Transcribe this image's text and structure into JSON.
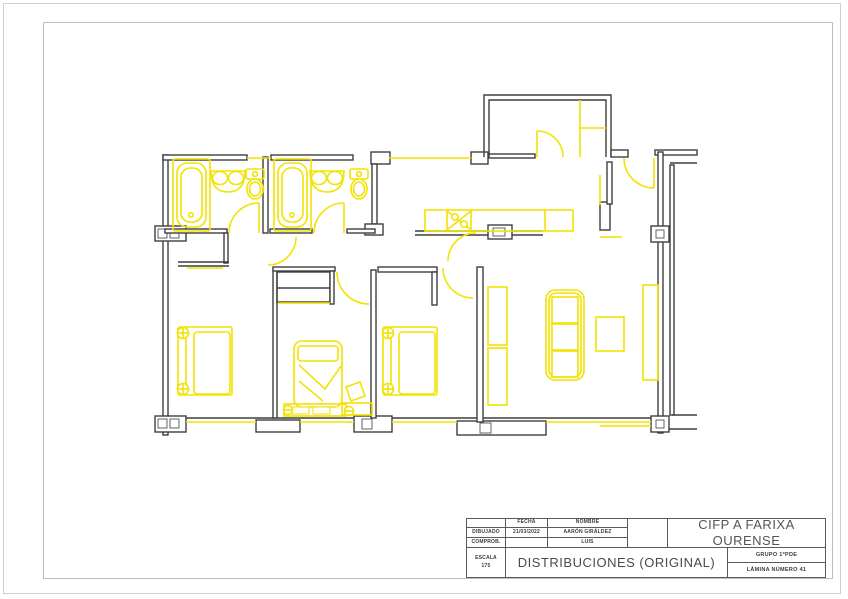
{
  "page": {
    "background": "#ffffff",
    "outer_border_color": "#cfcfcf",
    "inner_border_color": "#bdbdbd"
  },
  "title_block": {
    "fields": {
      "fecha_label": "FECHA",
      "nombre_label": "NOMBRE",
      "dibujado_label": "DIBUJADO",
      "fecha_value": "21/03/2022",
      "dibujado_nombre": "AARÓN GIRÁLDEZ",
      "comprob_label": "COMPROB.",
      "comprob_nombre": "LUIS",
      "escala_label": "ESCALA",
      "escala_value": "175",
      "drawing_title": "DISTRIBUCIONES (ORIGINAL)",
      "school_line1": "CIFP A FARIXA",
      "school_line2": "OURENSE",
      "grupo": "GRUPO 1ºPDE",
      "lamina": "LÁMINA NÚMERO 41"
    }
  },
  "plan": {
    "wall_color": "#3f3f3f",
    "accent_color": "#f2e300",
    "shapes": [
      {
        "t": "r",
        "x": 163,
        "y": 155,
        "w": 5,
        "h": 280,
        "f": "w"
      },
      {
        "t": "r",
        "x": 163,
        "y": 155,
        "w": 84,
        "h": 5,
        "f": "w"
      },
      {
        "t": "r",
        "x": 271,
        "y": 155,
        "w": 82,
        "h": 5,
        "f": "w"
      },
      {
        "t": "r",
        "x": 371,
        "y": 152,
        "w": 19,
        "h": 12,
        "f": "w"
      },
      {
        "t": "r",
        "x": 372,
        "y": 164,
        "w": 5,
        "h": 60,
        "f": "w"
      },
      {
        "t": "r",
        "x": 365,
        "y": 224,
        "w": 18,
        "h": 11,
        "f": "w"
      },
      {
        "t": "r",
        "x": 471,
        "y": 152,
        "w": 17,
        "h": 12,
        "f": "w"
      },
      {
        "t": "p",
        "d": "M484,157 L484,95 L611,95 L611,157"
      },
      {
        "t": "p",
        "d": "M489,157 L489,100 L606,100 L606,157"
      },
      {
        "t": "r",
        "x": 489,
        "y": 154,
        "w": 46,
        "h": 4,
        "f": "w"
      },
      {
        "t": "r",
        "x": 611,
        "y": 150,
        "w": 17,
        "h": 7,
        "f": "w"
      },
      {
        "t": "r",
        "x": 655,
        "y": 150,
        "w": 42,
        "h": 5,
        "f": "w"
      },
      {
        "t": "l",
        "x1": 670,
        "y1": 163,
        "x2": 697,
        "y2": 163
      },
      {
        "t": "r",
        "x": 658,
        "y": 152,
        "w": 5,
        "h": 281,
        "f": "w"
      },
      {
        "t": "r",
        "x": 670,
        "y": 165,
        "w": 4,
        "h": 250,
        "f": "w"
      },
      {
        "t": "l",
        "x1": 672,
        "y1": 415,
        "x2": 697,
        "y2": 415
      },
      {
        "t": "l",
        "x1": 657,
        "y1": 429,
        "x2": 697,
        "y2": 429
      },
      {
        "t": "l",
        "x1": 164,
        "y1": 418,
        "x2": 662,
        "y2": 418
      },
      {
        "t": "r",
        "x": 651,
        "y": 226,
        "w": 18,
        "h": 16,
        "f": "w"
      },
      {
        "t": "r",
        "x": 656,
        "y": 230,
        "w": 8,
        "h": 8,
        "f": "w",
        "sw": 0.8
      },
      {
        "t": "r",
        "x": 651,
        "y": 416,
        "w": 18,
        "h": 16,
        "f": "w"
      },
      {
        "t": "r",
        "x": 656,
        "y": 420,
        "w": 8,
        "h": 8,
        "f": "w",
        "sw": 0.8
      },
      {
        "t": "r",
        "x": 155,
        "y": 416,
        "w": 31,
        "h": 16,
        "f": "w"
      },
      {
        "t": "r",
        "x": 158,
        "y": 419,
        "w": 9,
        "h": 9,
        "f": "w",
        "sw": 0.8
      },
      {
        "t": "r",
        "x": 170,
        "y": 419,
        "w": 9,
        "h": 9,
        "f": "w",
        "sw": 0.8
      },
      {
        "t": "r",
        "x": 256,
        "y": 420,
        "w": 44,
        "h": 12,
        "f": "w"
      },
      {
        "t": "r",
        "x": 354,
        "y": 416,
        "w": 38,
        "h": 16,
        "f": "w"
      },
      {
        "t": "r",
        "x": 362,
        "y": 419,
        "w": 10,
        "h": 10,
        "f": "w",
        "sw": 0.8
      },
      {
        "t": "r",
        "x": 457,
        "y": 421,
        "w": 89,
        "h": 14,
        "f": "w"
      },
      {
        "t": "r",
        "x": 480,
        "y": 423,
        "w": 11,
        "h": 10,
        "f": "w",
        "sw": 0.8
      },
      {
        "t": "r",
        "x": 155,
        "y": 226,
        "w": 31,
        "h": 15,
        "f": "w"
      },
      {
        "t": "r",
        "x": 158,
        "y": 229,
        "w": 9,
        "h": 9,
        "f": "w",
        "sw": 0.8
      },
      {
        "t": "r",
        "x": 170,
        "y": 229,
        "w": 9,
        "h": 9,
        "f": "w",
        "sw": 0.8
      },
      {
        "t": "r",
        "x": 263,
        "y": 157,
        "w": 5,
        "h": 76,
        "f": "w"
      },
      {
        "t": "r",
        "x": 165,
        "y": 229,
        "w": 62,
        "h": 4,
        "f": "w"
      },
      {
        "t": "r",
        "x": 224,
        "y": 233,
        "w": 4,
        "h": 30,
        "f": "w"
      },
      {
        "t": "l",
        "x1": 178,
        "y1": 262,
        "x2": 229,
        "y2": 262
      },
      {
        "t": "l",
        "x1": 178,
        "y1": 266,
        "x2": 229,
        "y2": 266
      },
      {
        "t": "r",
        "x": 270,
        "y": 229,
        "w": 42,
        "h": 4,
        "f": "w"
      },
      {
        "t": "r",
        "x": 347,
        "y": 229,
        "w": 28,
        "h": 4,
        "f": "w"
      },
      {
        "t": "r",
        "x": 371,
        "y": 270,
        "w": 5,
        "h": 148,
        "f": "w"
      },
      {
        "t": "r",
        "x": 273,
        "y": 270,
        "w": 4,
        "h": 148,
        "f": "w"
      },
      {
        "t": "r",
        "x": 273,
        "y": 267,
        "w": 62,
        "h": 4,
        "f": "w"
      },
      {
        "t": "r",
        "x": 277,
        "y": 272,
        "w": 53,
        "h": 30
      },
      {
        "t": "l",
        "x1": 277,
        "y1": 288,
        "x2": 330,
        "y2": 288
      },
      {
        "t": "r",
        "x": 330,
        "y": 271,
        "w": 4,
        "h": 33,
        "f": "w"
      },
      {
        "t": "r",
        "x": 378,
        "y": 267,
        "w": 59,
        "h": 5,
        "f": "w"
      },
      {
        "t": "r",
        "x": 432,
        "y": 272,
        "w": 5,
        "h": 33,
        "f": "w"
      },
      {
        "t": "r",
        "x": 477,
        "y": 267,
        "w": 6,
        "h": 155,
        "f": "w"
      },
      {
        "t": "l",
        "x1": 415,
        "y1": 231,
        "x2": 543,
        "y2": 231
      },
      {
        "t": "l",
        "x1": 415,
        "y1": 235,
        "x2": 543,
        "y2": 235
      },
      {
        "t": "r",
        "x": 488,
        "y": 225,
        "w": 24,
        "h": 14,
        "f": "w"
      },
      {
        "t": "r",
        "x": 493,
        "y": 228,
        "w": 12,
        "h": 8,
        "f": "w",
        "sw": 0.8
      },
      {
        "t": "r",
        "x": 600,
        "y": 202,
        "w": 10,
        "h": 28
      },
      {
        "t": "r",
        "x": 607,
        "y": 162,
        "w": 5,
        "h": 42,
        "f": "w"
      },
      {
        "t": "l",
        "l": "y",
        "x1": 247,
        "y1": 158,
        "x2": 271,
        "y2": 158
      },
      {
        "t": "l",
        "l": "y",
        "x1": 389,
        "y1": 158,
        "x2": 471,
        "y2": 158
      },
      {
        "t": "l",
        "l": "y",
        "x1": 186,
        "y1": 422,
        "x2": 256,
        "y2": 422
      },
      {
        "t": "l",
        "l": "y",
        "x1": 300,
        "y1": 422,
        "x2": 354,
        "y2": 422
      },
      {
        "t": "l",
        "l": "y",
        "x1": 392,
        "y1": 422,
        "x2": 457,
        "y2": 422
      },
      {
        "t": "l",
        "l": "y",
        "x1": 546,
        "y1": 422,
        "x2": 651,
        "y2": 422
      },
      {
        "t": "l",
        "l": "y",
        "x1": 600,
        "y1": 426,
        "x2": 651,
        "y2": 426
      },
      {
        "t": "l",
        "l": "y",
        "x1": 187,
        "y1": 268,
        "x2": 223,
        "y2": 268
      },
      {
        "t": "l",
        "l": "y",
        "x1": 278,
        "y1": 303,
        "x2": 330,
        "y2": 303
      },
      {
        "t": "l",
        "l": "y",
        "x1": 600,
        "y1": 237,
        "x2": 622,
        "y2": 237
      },
      {
        "t": "l",
        "l": "y",
        "x1": 600,
        "y1": 175,
        "x2": 600,
        "y2": 205
      },
      {
        "t": "l",
        "l": "y",
        "x1": 259,
        "y1": 203,
        "x2": 259,
        "y2": 233
      },
      {
        "t": "p",
        "l": "y",
        "d": "M259,203 A30,30 0 0 0 229,233"
      },
      {
        "t": "l",
        "l": "y",
        "x1": 344,
        "y1": 203,
        "x2": 344,
        "y2": 233
      },
      {
        "t": "p",
        "l": "y",
        "d": "M344,203 A30,30 0 0 0 314,233"
      },
      {
        "t": "p",
        "l": "y",
        "d": "M296,237 A28,28 0 0 1 268,265"
      },
      {
        "t": "p",
        "l": "y",
        "d": "M337,272 A32,32 0 0 0 369,304"
      },
      {
        "t": "p",
        "l": "y",
        "d": "M443,268 A30,30 0 0 0 473,298"
      },
      {
        "t": "l",
        "l": "y",
        "x1": 537,
        "y1": 131,
        "x2": 537,
        "y2": 157
      },
      {
        "t": "p",
        "l": "y",
        "d": "M537,131 A26,26 0 0 1 563,157"
      },
      {
        "t": "l",
        "l": "y",
        "x1": 654,
        "y1": 158,
        "x2": 654,
        "y2": 188
      },
      {
        "t": "p",
        "l": "y",
        "d": "M624,158 A30,30 0 0 0 654,188"
      },
      {
        "t": "p",
        "l": "y",
        "d": "M448,261 A28,28 0 0 1 476,233"
      },
      {
        "t": "l",
        "l": "y",
        "x1": 580,
        "y1": 100,
        "x2": 580,
        "y2": 157
      },
      {
        "t": "l",
        "l": "y",
        "x1": 580,
        "y1": 128,
        "x2": 606,
        "y2": 128
      },
      {
        "t": "r",
        "l": "y",
        "x": 173,
        "y": 159,
        "w": 37,
        "h": 72,
        "rx": 2
      },
      {
        "t": "r",
        "l": "y",
        "x": 177,
        "y": 163,
        "w": 29,
        "h": 64,
        "rx": 10
      },
      {
        "t": "r",
        "l": "y",
        "x": 181,
        "y": 168,
        "w": 21,
        "h": 54,
        "rx": 9
      },
      {
        "t": "c",
        "l": "y",
        "cx": 191,
        "cy": 215,
        "r": 2.2
      },
      {
        "t": "r",
        "l": "y",
        "x": 274,
        "y": 159,
        "w": 37,
        "h": 72,
        "rx": 2
      },
      {
        "t": "r",
        "l": "y",
        "x": 278,
        "y": 163,
        "w": 29,
        "h": 64,
        "rx": 10
      },
      {
        "t": "r",
        "l": "y",
        "x": 282,
        "y": 168,
        "w": 21,
        "h": 54,
        "rx": 9
      },
      {
        "t": "c",
        "l": "y",
        "cx": 292,
        "cy": 215,
        "r": 2.2
      },
      {
        "t": "p",
        "l": "y",
        "d": "M211,171 Q211,192 228,192 Q245,192 245,171 Z"
      },
      {
        "t": "e",
        "l": "y",
        "cx": 220,
        "cy": 178,
        "rx": 7.5,
        "ry": 6.5
      },
      {
        "t": "e",
        "l": "y",
        "cx": 236,
        "cy": 178,
        "rx": 7.5,
        "ry": 6.5
      },
      {
        "t": "p",
        "l": "y",
        "d": "M310,171 Q310,192 327,192 Q344,192 344,171 Z"
      },
      {
        "t": "e",
        "l": "y",
        "cx": 319,
        "cy": 178,
        "rx": 7.5,
        "ry": 6.5
      },
      {
        "t": "e",
        "l": "y",
        "cx": 335,
        "cy": 178,
        "rx": 7.5,
        "ry": 6.5
      },
      {
        "t": "r",
        "l": "y",
        "x": 246,
        "y": 169,
        "w": 18,
        "h": 10,
        "rx": 2
      },
      {
        "t": "c",
        "l": "y",
        "cx": 255,
        "cy": 174,
        "r": 2.4
      },
      {
        "t": "e",
        "l": "y",
        "cx": 255,
        "cy": 189,
        "rx": 8,
        "ry": 10
      },
      {
        "t": "e",
        "l": "y",
        "cx": 255,
        "cy": 189,
        "rx": 5.5,
        "ry": 7
      },
      {
        "t": "r",
        "l": "y",
        "x": 350,
        "y": 169,
        "w": 18,
        "h": 10,
        "rx": 2
      },
      {
        "t": "c",
        "l": "y",
        "cx": 359,
        "cy": 174,
        "r": 2.4
      },
      {
        "t": "e",
        "l": "y",
        "cx": 359,
        "cy": 189,
        "rx": 8,
        "ry": 10
      },
      {
        "t": "e",
        "l": "y",
        "cx": 359,
        "cy": 189,
        "rx": 5.5,
        "ry": 7
      },
      {
        "t": "r",
        "l": "y",
        "x": 425,
        "y": 210,
        "w": 148,
        "h": 21
      },
      {
        "t": "l",
        "l": "y",
        "x1": 447,
        "y1": 210,
        "x2": 447,
        "y2": 231
      },
      {
        "t": "l",
        "l": "y",
        "x1": 471,
        "y1": 210,
        "x2": 471,
        "y2": 231
      },
      {
        "t": "l",
        "l": "y",
        "x1": 545,
        "y1": 210,
        "x2": 545,
        "y2": 231
      },
      {
        "t": "l",
        "l": "y",
        "x1": 447,
        "y1": 211,
        "x2": 471,
        "y2": 230
      },
      {
        "t": "l",
        "l": "y",
        "x1": 471,
        "y1": 211,
        "x2": 447,
        "y2": 230
      },
      {
        "t": "c",
        "l": "y",
        "cx": 455,
        "cy": 217,
        "r": 3.2,
        "f": "w"
      },
      {
        "t": "c",
        "l": "y",
        "cx": 464,
        "cy": 224,
        "r": 3.2,
        "f": "w"
      },
      {
        "t": "r",
        "l": "y",
        "x": 178,
        "y": 327,
        "w": 54,
        "h": 68,
        "rx": 2
      },
      {
        "t": "r",
        "l": "y",
        "x": 194,
        "y": 332,
        "w": 36,
        "h": 62,
        "rx": 3
      },
      {
        "t": "l",
        "l": "y",
        "x1": 186,
        "y1": 327,
        "x2": 186,
        "y2": 395
      },
      {
        "t": "c",
        "l": "y",
        "cx": 183,
        "cy": 333,
        "r": 5.5,
        "f": "w"
      },
      {
        "t": "l",
        "l": "y",
        "x1": 177,
        "y1": 333,
        "x2": 189,
        "y2": 333
      },
      {
        "t": "l",
        "l": "y",
        "x1": 183,
        "y1": 327,
        "x2": 183,
        "y2": 339
      },
      {
        "t": "c",
        "l": "y",
        "cx": 183,
        "cy": 389,
        "r": 5.5,
        "f": "w"
      },
      {
        "t": "l",
        "l": "y",
        "x1": 177,
        "y1": 389,
        "x2": 189,
        "y2": 389
      },
      {
        "t": "l",
        "l": "y",
        "x1": 183,
        "y1": 383,
        "x2": 183,
        "y2": 395
      },
      {
        "t": "r",
        "l": "y",
        "x": 383,
        "y": 327,
        "w": 54,
        "h": 68,
        "rx": 2
      },
      {
        "t": "r",
        "l": "y",
        "x": 399,
        "y": 332,
        "w": 36,
        "h": 62,
        "rx": 3
      },
      {
        "t": "l",
        "l": "y",
        "x1": 391,
        "y1": 327,
        "x2": 391,
        "y2": 395
      },
      {
        "t": "c",
        "l": "y",
        "cx": 388,
        "cy": 333,
        "r": 5.5,
        "f": "w"
      },
      {
        "t": "l",
        "l": "y",
        "x1": 382,
        "y1": 333,
        "x2": 394,
        "y2": 333
      },
      {
        "t": "l",
        "l": "y",
        "x1": 388,
        "y1": 327,
        "x2": 388,
        "y2": 339
      },
      {
        "t": "c",
        "l": "y",
        "cx": 388,
        "cy": 389,
        "r": 5.5,
        "f": "w"
      },
      {
        "t": "l",
        "l": "y",
        "x1": 382,
        "y1": 389,
        "x2": 394,
        "y2": 389
      },
      {
        "t": "l",
        "l": "y",
        "x1": 388,
        "y1": 383,
        "x2": 388,
        "y2": 395
      },
      {
        "t": "r",
        "l": "y",
        "x": 294,
        "y": 341,
        "w": 48,
        "h": 66,
        "rx": 8
      },
      {
        "t": "r",
        "l": "y",
        "x": 298,
        "y": 346,
        "w": 40,
        "h": 15,
        "rx": 3
      },
      {
        "t": "p",
        "l": "y",
        "d": "M299,365 L325,389 L341,366"
      },
      {
        "t": "p",
        "l": "y",
        "d": "M299,381 L323,401"
      },
      {
        "t": "r",
        "l": "y",
        "x": 284,
        "y": 404,
        "w": 62,
        "h": 12
      },
      {
        "t": "r",
        "l": "y",
        "x": 292,
        "y": 407,
        "w": 17,
        "h": 7,
        "f": "w",
        "sw": 1
      },
      {
        "t": "r",
        "l": "y",
        "x": 313,
        "y": 407,
        "w": 17,
        "h": 7,
        "f": "w",
        "sw": 1
      },
      {
        "t": "c",
        "l": "y",
        "cx": 288,
        "cy": 410,
        "r": 4.5,
        "f": "w"
      },
      {
        "t": "l",
        "l": "y",
        "x1": 283,
        "y1": 410,
        "x2": 293,
        "y2": 410
      },
      {
        "t": "c",
        "l": "y",
        "cx": 349,
        "cy": 411,
        "r": 4.5,
        "f": "w"
      },
      {
        "t": "l",
        "l": "y",
        "x1": 344,
        "y1": 411,
        "x2": 354,
        "y2": 411
      },
      {
        "t": "r",
        "l": "y",
        "x": 342,
        "y": 403,
        "w": 30,
        "h": 12
      },
      {
        "t": "p",
        "l": "y",
        "d": "M346,387 L360,382 L365,396 L351,401 Z"
      },
      {
        "t": "r",
        "l": "y",
        "x": 546,
        "y": 290,
        "w": 38,
        "h": 90,
        "rx": 9
      },
      {
        "t": "r",
        "l": "y",
        "x": 549,
        "y": 293,
        "w": 32,
        "h": 84,
        "rx": 7
      },
      {
        "t": "r",
        "l": "y",
        "x": 552,
        "y": 297,
        "w": 26,
        "h": 26
      },
      {
        "t": "r",
        "l": "y",
        "x": 552,
        "y": 324,
        "w": 26,
        "h": 26
      },
      {
        "t": "r",
        "l": "y",
        "x": 552,
        "y": 351,
        "w": 26,
        "h": 26
      },
      {
        "t": "r",
        "l": "y",
        "x": 596,
        "y": 317,
        "w": 28,
        "h": 34
      },
      {
        "t": "r",
        "l": "y",
        "x": 488,
        "y": 287,
        "w": 19,
        "h": 58
      },
      {
        "t": "r",
        "l": "y",
        "x": 488,
        "y": 348,
        "w": 19,
        "h": 57
      },
      {
        "t": "r",
        "l": "y",
        "x": 643,
        "y": 285,
        "w": 15,
        "h": 95
      }
    ]
  }
}
